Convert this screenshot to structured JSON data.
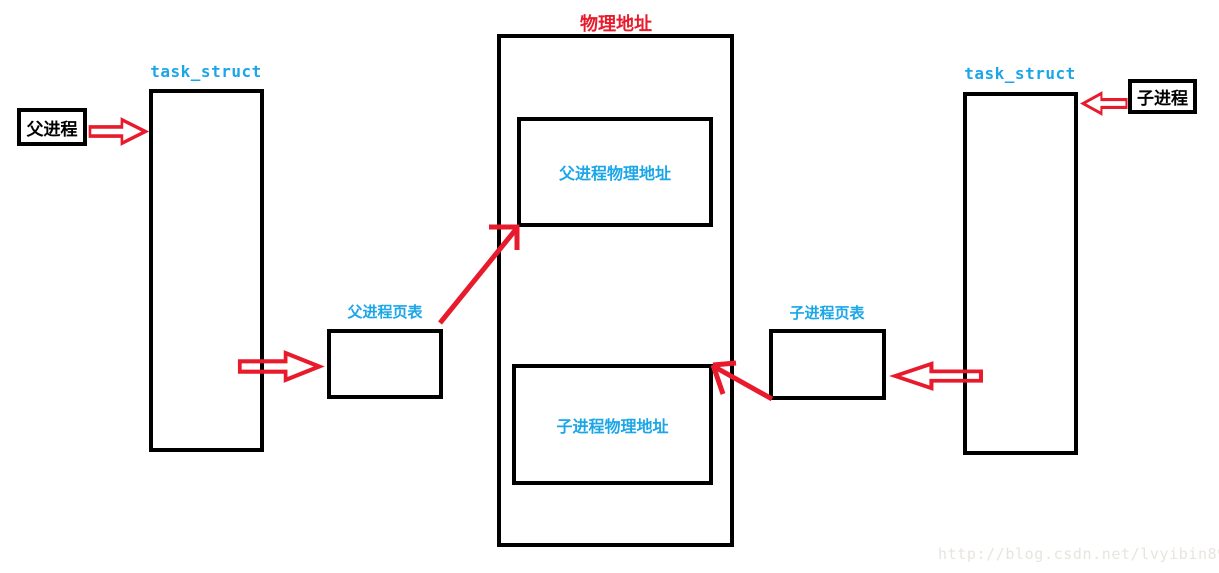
{
  "colors": {
    "red": "#e81b2c",
    "cyan": "#1ba6e8",
    "black": "#000000",
    "watermark": "#e8e5de"
  },
  "diagram": {
    "physical_address": {
      "title": "物理地址",
      "parent_block_label": "父进程物理地址",
      "child_block_label": "子进程物理地址"
    },
    "parent": {
      "entry_label": "父进程",
      "task_struct_label": "task_struct",
      "page_table_label": "父进程页表"
    },
    "child": {
      "entry_label": "子进程",
      "task_struct_label": "task_struct",
      "page_table_label": "子进程页表"
    },
    "watermark": "http://blog.csdn.net/lvyibin890"
  },
  "icons": {
    "arrow-right-icon": "hollow red block arrow pointing right",
    "arrow-left-icon": "hollow red block arrow pointing left",
    "arrow-up-right-icon": "red line arrow pointing up-right",
    "arrow-up-left-icon": "red line arrow pointing up-left"
  }
}
